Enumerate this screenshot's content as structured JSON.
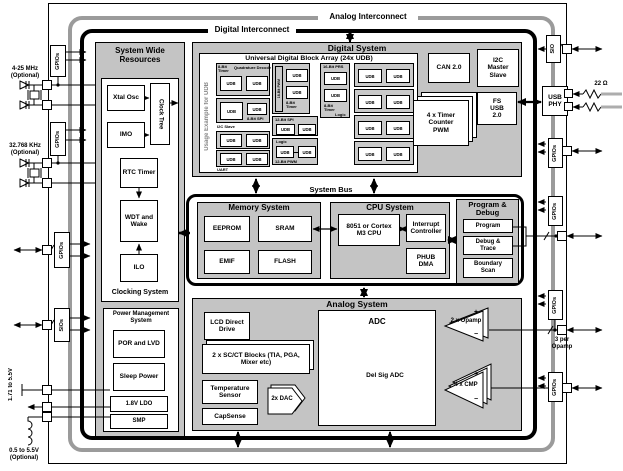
{
  "ic": {
    "analog": "Analog Interconnect",
    "digital": "Digital Interconnect",
    "bus": "System Bus"
  },
  "swr": {
    "title": "System Wide Resources",
    "xtal": "Xtal Osc",
    "clock_tree": "Clock Tree",
    "imo": "IMO",
    "rtc": "RTC Timer",
    "wdt": "WDT and Wake",
    "ilo": "ILO",
    "clocking": "Clocking System",
    "pm_title": "Power Management System",
    "por": "POR and LVD",
    "sleep": "Sleep Power",
    "ldo": "1.8V LDO",
    "smp": "SMP"
  },
  "ds": {
    "title": "Digital System",
    "udb_title": "Universal Digital Block Array (24x UDB)",
    "usage": "Usage Example for UDB",
    "udb": "UDB",
    "t_timer8": "8-Bit Timer",
    "t_quad": "Quadrature Decoder",
    "t_spi8": "8-Bit SPI",
    "t_i2c": "I2C Slave",
    "t_uart": "UART",
    "t_pwm16": "16-Bit PWM",
    "t_prs16": "16-Bit PRS",
    "t_spi12": "12-Bit SPI",
    "t_pwm12": "12-Bit PWM",
    "t_logic": "Logic",
    "can": "CAN 2.0",
    "i2c": "I2C Master Slave",
    "tcpwm": "4 x Timer Counter PWM",
    "usb": "FS USB 2.0"
  },
  "mem": {
    "title": "Memory System",
    "eeprom": "EEPROM",
    "sram": "SRAM",
    "emif": "EMIF",
    "flash": "FLASH"
  },
  "cpu": {
    "title": "CPU System",
    "core": "8051 or Cortex M3 CPU",
    "irq": "Interrupt Controller",
    "dma": "PHUB DMA"
  },
  "pd": {
    "title": "Program & Debug",
    "program": "Program",
    "trace": "Debug & Trace",
    "boundary": "Boundary Scan"
  },
  "an": {
    "title": "Analog System",
    "lcd": "LCD Direct Drive",
    "scct": "2 x SC/CT Blocks (TIA, PGA, Mixer etc)",
    "temp": "Temperature Sensor",
    "cap": "CapSense",
    "dac": "2x DAC",
    "adc": "ADC",
    "delsig": "Del Sig ADC",
    "opamp": "2 x Opamp",
    "cmp": "4 x CMP",
    "plus": "+",
    "minus": "−"
  },
  "left": {
    "gpio": "GPIOs",
    "sios": "SIOs",
    "mhz": "4-25 MHz (Optional)",
    "khz": "32.768 KHz (Optional)",
    "vrange": "1.71 to 5.5V",
    "vopt": "0.5 to 5.5V (Optional)"
  },
  "right": {
    "sio": "SIO",
    "phy": "USB PHY",
    "ohm": "22 Ω",
    "gpio": "GPIOs",
    "note": "3 per Opamp"
  },
  "colors": {
    "band_gray": "#9b9b9b",
    "fill_gray": "#c4c4c4",
    "accent": "#000000"
  }
}
